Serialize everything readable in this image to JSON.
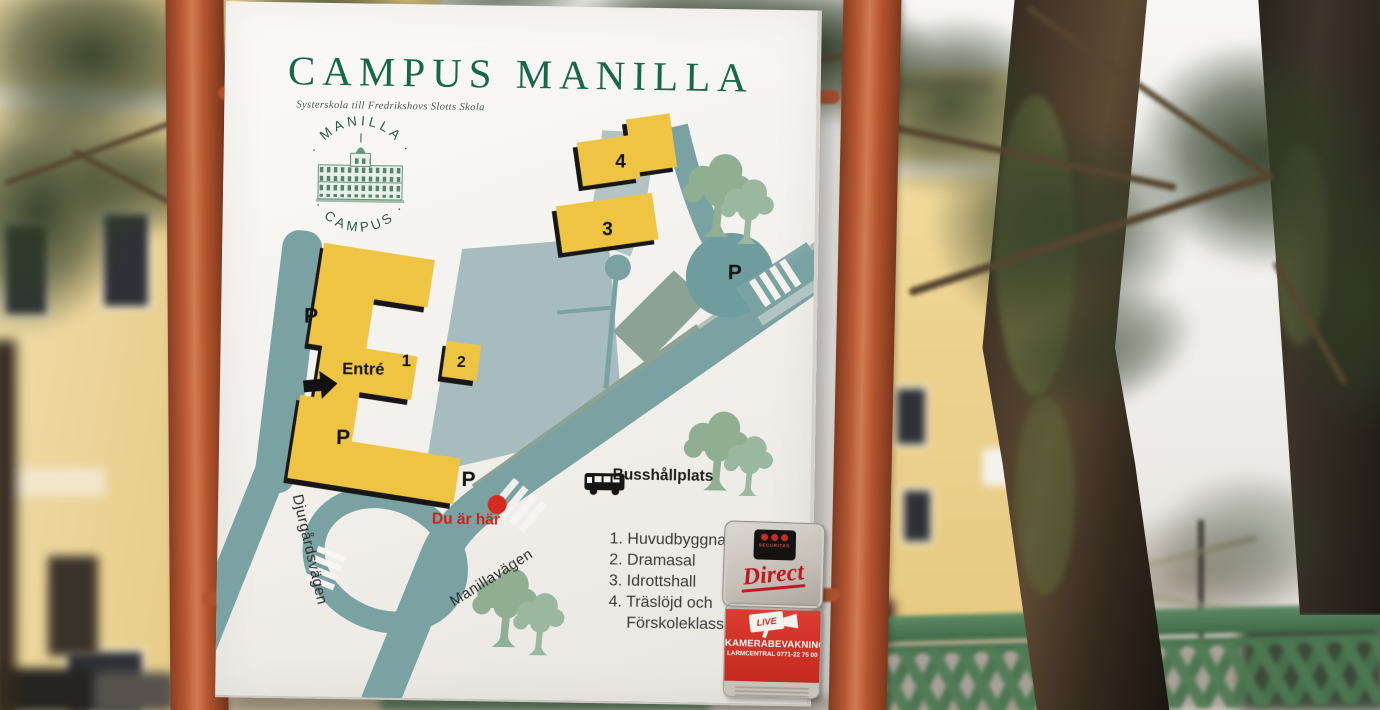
{
  "sign": {
    "title": "CAMPUS MANILLA",
    "subtitle": "Systerskola till Fredrikshovs Slotts Skola",
    "logo": {
      "arc_top": "· MANILLA ·",
      "arc_bottom": "· CAMPUS ·"
    },
    "map": {
      "labels": {
        "building1": "1",
        "building2": "2",
        "building3": "3",
        "building4": "4",
        "entrance": "Entré",
        "parking": "P",
        "you_are_here": "Du är här",
        "bus_stop": "Busshållplats"
      },
      "streets": {
        "left": "Djurgårdsvägen",
        "diagonal": "Manillavägen"
      },
      "legend": [
        "1. Huvudbyggnad",
        "2. Dramasal",
        "3. Idrottshall",
        "4. Träslöjd och",
        "Förskoleklass"
      ]
    },
    "stickers": {
      "securitas": {
        "brand": "SECURITAS",
        "product": "Direct"
      },
      "camera": {
        "live": "LIVE",
        "line1": "KAMERABEVAKNING",
        "line2": "LARMCENTRAL 0771-22 75 00"
      }
    },
    "colors": {
      "title_green": "#17684a",
      "road_teal": "#7aa2a2",
      "building_yellow": "#eec442",
      "post_orange": "#b5552f",
      "alert_red": "#c9251b"
    }
  }
}
